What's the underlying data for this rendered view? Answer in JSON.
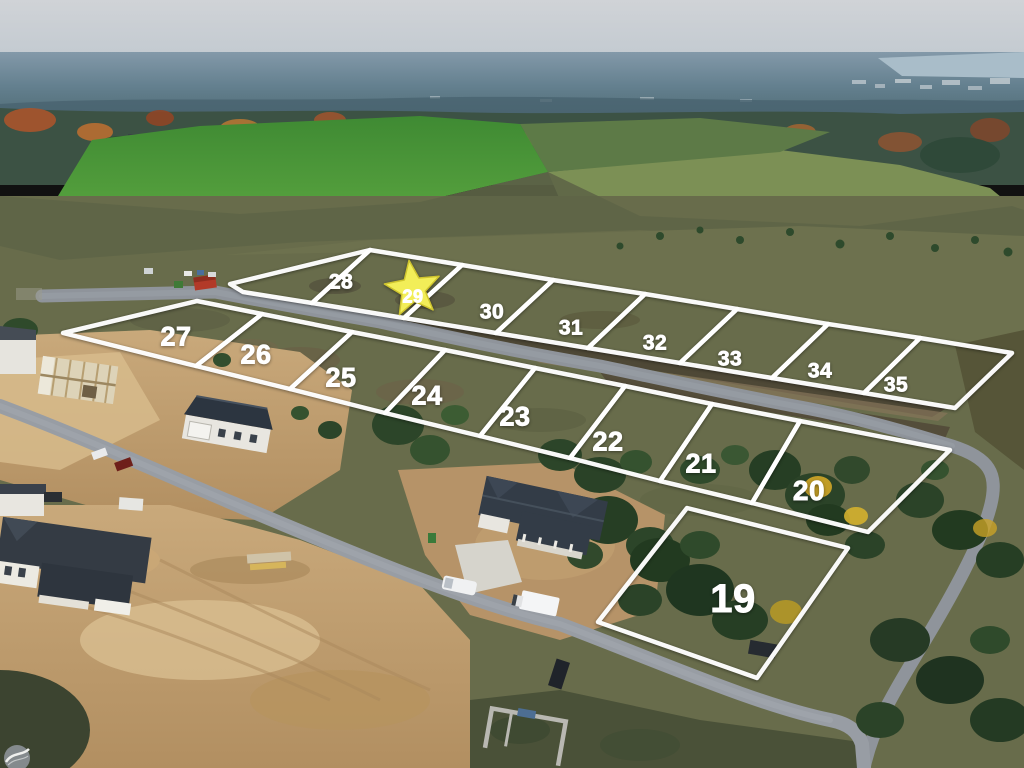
{
  "scene": {
    "type": "aerial-drone-photo",
    "subject": "residential development lots for sale with numbered boundary overlays"
  },
  "boundary_style": {
    "stroke": "#ffffff",
    "width": 4.5
  },
  "label_style": {
    "color": "#ffffff"
  },
  "star_marker": {
    "on_lot": "29",
    "fill": "#f2ee58",
    "edge": "#cfc52f",
    "cx": 413,
    "cy": 289,
    "outer_radius": 29,
    "inner_radius": 12.5,
    "rotation": -8
  },
  "lots": [
    {
      "number": "28",
      "polygon": "230,284 370,250 312,303 243,292",
      "label": {
        "x": 341,
        "y": 281,
        "size": 21
      }
    },
    {
      "number": "29",
      "star": true,
      "polygon": "370,250 462,265 404,318 312,303",
      "label": {
        "x": 413,
        "y": 296,
        "size": 18
      }
    },
    {
      "number": "30",
      "polygon": "462,265 553,280 496,333 404,318",
      "label": {
        "x": 492,
        "y": 311,
        "size": 21
      }
    },
    {
      "number": "31",
      "polygon": "553,280 645,294 588,348 496,333",
      "label": {
        "x": 571,
        "y": 327,
        "size": 21
      }
    },
    {
      "number": "32",
      "polygon": "645,294 737,309 680,363 588,348",
      "label": {
        "x": 655,
        "y": 342,
        "size": 21
      }
    },
    {
      "number": "33",
      "polygon": "737,309 828,324 772,378 680,363",
      "label": {
        "x": 730,
        "y": 358,
        "size": 21
      }
    },
    {
      "number": "34",
      "polygon": "828,324 920,338 864,393 772,378",
      "label": {
        "x": 820,
        "y": 370,
        "size": 21
      }
    },
    {
      "number": "35",
      "polygon": "920,338 1012,353 955,408 864,393",
      "label": {
        "x": 896,
        "y": 384,
        "size": 21
      }
    },
    {
      "number": "27",
      "polygon": "63,333 197,301 262,314 196,366",
      "label": {
        "x": 176,
        "y": 336,
        "size": 27
      }
    },
    {
      "number": "26",
      "polygon": "262,314 352,332 290,389 196,366",
      "label": {
        "x": 256,
        "y": 354,
        "size": 27
      }
    },
    {
      "number": "25",
      "polygon": "352,332 445,350 385,413 290,389",
      "label": {
        "x": 341,
        "y": 377,
        "size": 27
      }
    },
    {
      "number": "24",
      "polygon": "445,350 535,368 480,436 385,413",
      "label": {
        "x": 427,
        "y": 395,
        "size": 27
      }
    },
    {
      "number": "23",
      "polygon": "535,368 625,386 570,458 480,436",
      "label": {
        "x": 515,
        "y": 416,
        "size": 27
      }
    },
    {
      "number": "22",
      "polygon": "625,386 712,404 660,481 570,458",
      "label": {
        "x": 608,
        "y": 441,
        "size": 27
      }
    },
    {
      "number": "21",
      "polygon": "712,404 800,421 752,503 660,481",
      "label": {
        "x": 701,
        "y": 463,
        "size": 27
      }
    },
    {
      "number": "20",
      "polygon": "800,421 950,450 868,532 752,503",
      "label": {
        "x": 809,
        "y": 490,
        "size": 28
      }
    },
    {
      "number": "19",
      "polygon": "687,508 848,548 757,678 598,622",
      "label": {
        "x": 733,
        "y": 598,
        "size": 40
      }
    }
  ],
  "watermark": {
    "name": "circle-swoosh-logo",
    "color": "#8b9095"
  }
}
